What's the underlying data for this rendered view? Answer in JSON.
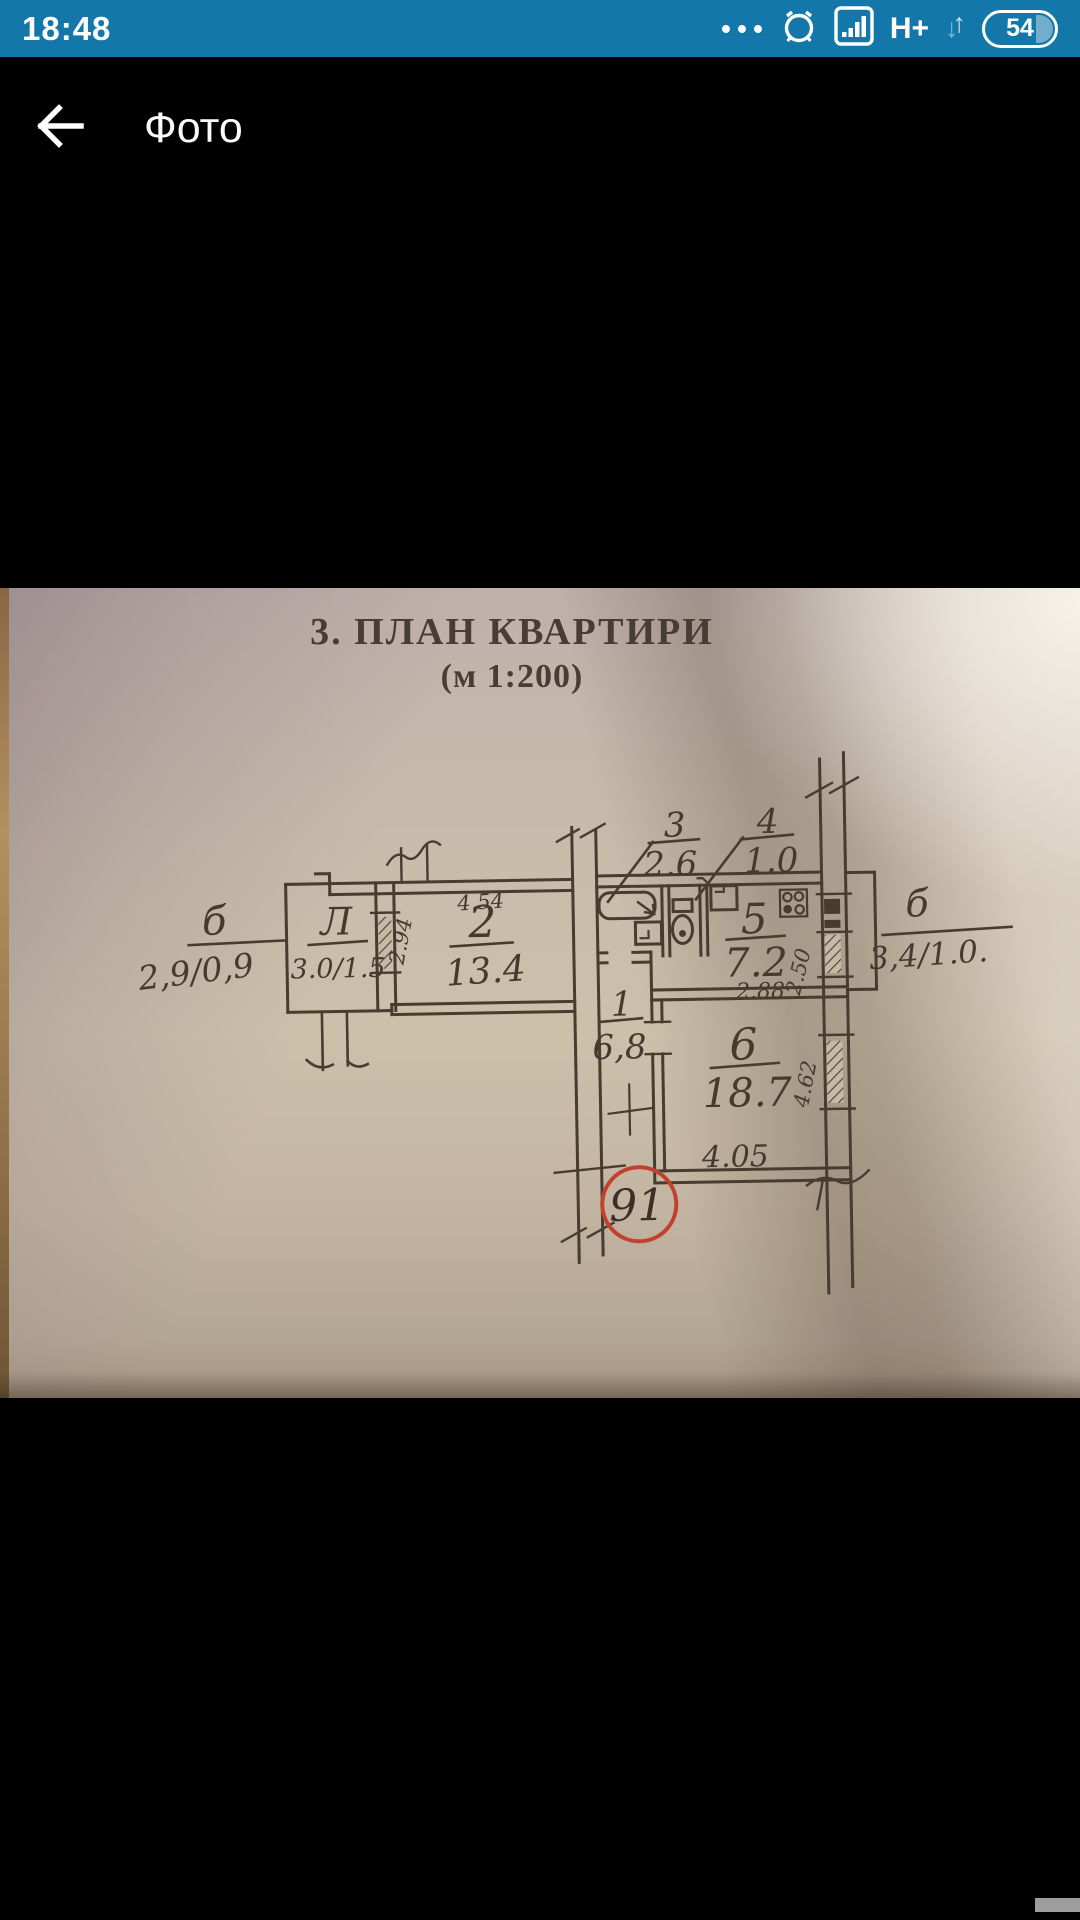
{
  "status_bar": {
    "time": "18:48",
    "network": "H+",
    "battery_percent": "54"
  },
  "app_bar": {
    "title": "Фото"
  },
  "plan": {
    "title": "3. ПЛАН КВАРТИРИ",
    "scale": "(м 1:200)",
    "apartment_number": "91",
    "balcony_left": {
      "letter": "б",
      "dims": "2,9/0,9"
    },
    "loggia": {
      "letter": "Л",
      "dims": "3.0/1.5"
    },
    "room2": {
      "num": "2",
      "area": "13.4",
      "width": "4.54",
      "depth": "2.94"
    },
    "room3": {
      "num": "3",
      "area": "2.6"
    },
    "room4": {
      "num": "4",
      "area": "1.0"
    },
    "room5": {
      "num": "5",
      "area": "7.2",
      "width": "2.88",
      "depth": "2.50"
    },
    "room1": {
      "num": "1",
      "area": "6,8"
    },
    "room6": {
      "num": "6",
      "area": "18.7",
      "width": "4.05",
      "depth": "4.62"
    },
    "balcony_right": {
      "letter": "б",
      "dims": "3,4/1.0."
    }
  }
}
